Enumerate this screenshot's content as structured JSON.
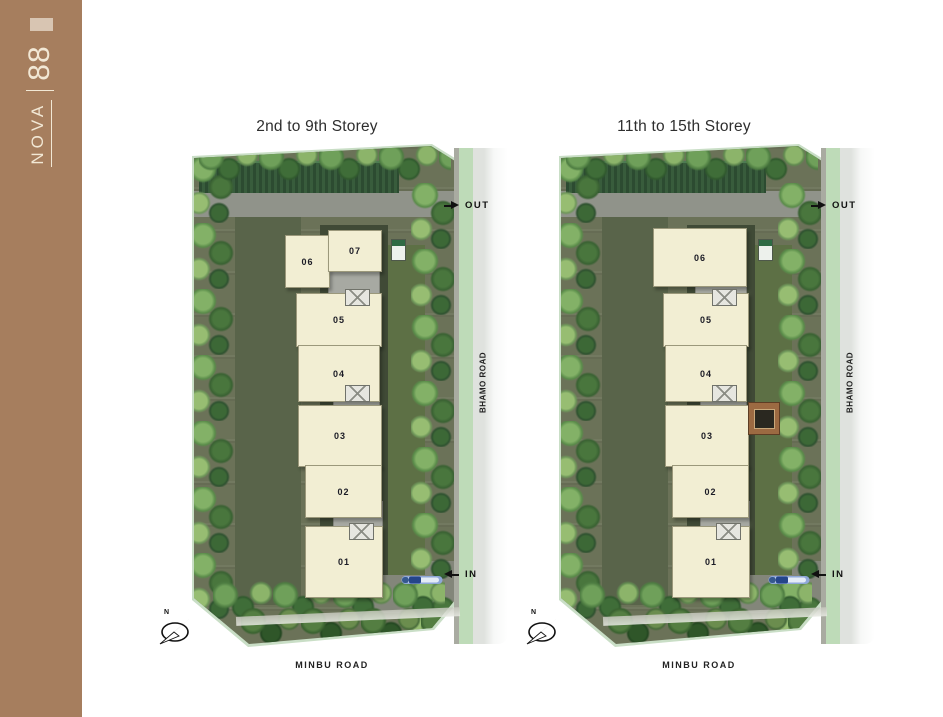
{
  "brand": {
    "name": "NOVA",
    "number": "88"
  },
  "colors": {
    "sidebar_brown": "#a67e5e",
    "logo_block": "#d8c5b2",
    "brand_text": "#f2e8d5",
    "unit_fill": "#f2eed3",
    "core_gray": "#a7a9a2",
    "road_green_strip": "#bedbb8",
    "ground_olive": "#6b7258"
  },
  "plans": [
    {
      "title": "2nd to 9th Storey",
      "out_label": "OUT",
      "in_label": "IN",
      "side_road_label": "BHAMO ROAD",
      "bottom_road_label": "MINBU ROAD",
      "compass_label": "N",
      "units": [
        {
          "label": "06",
          "x": 100,
          "y": 90,
          "w": 43,
          "h": 51
        },
        {
          "label": "07",
          "x": 143,
          "y": 85,
          "w": 52,
          "h": 40
        },
        {
          "label": "05",
          "x": 111,
          "y": 148,
          "w": 84,
          "h": 52
        },
        {
          "label": "04",
          "x": 113,
          "y": 200,
          "w": 80,
          "h": 55
        },
        {
          "label": "03",
          "x": 113,
          "y": 260,
          "w": 82,
          "h": 60
        },
        {
          "label": "02",
          "x": 120,
          "y": 320,
          "w": 75,
          "h": 51
        },
        {
          "label": "01",
          "x": 120,
          "y": 381,
          "w": 76,
          "h": 70
        }
      ],
      "cores": [
        {
          "x": 143,
          "y": 123,
          "w": 50,
          "h": 38
        },
        {
          "x": 148,
          "y": 238,
          "w": 45,
          "h": 40
        },
        {
          "x": 148,
          "y": 356,
          "w": 48,
          "h": 42
        }
      ],
      "lifts": [
        {
          "x": 160,
          "y": 144,
          "w": 23,
          "h": 15
        },
        {
          "x": 160,
          "y": 240,
          "w": 23,
          "h": 15
        },
        {
          "x": 164,
          "y": 378,
          "w": 23,
          "h": 15
        }
      ],
      "features": {
        "utility_box": true,
        "frame_marker": false
      }
    },
    {
      "title": "11th to 15th Storey",
      "out_label": "OUT",
      "in_label": "IN",
      "side_road_label": "BHAMO ROAD",
      "bottom_road_label": "MINBU ROAD",
      "compass_label": "N",
      "units": [
        {
          "label": "06",
          "x": 101,
          "y": 83,
          "w": 92,
          "h": 57
        },
        {
          "label": "05",
          "x": 111,
          "y": 148,
          "w": 84,
          "h": 52
        },
        {
          "label": "04",
          "x": 113,
          "y": 200,
          "w": 80,
          "h": 55
        },
        {
          "label": "03",
          "x": 113,
          "y": 260,
          "w": 82,
          "h": 60
        },
        {
          "label": "02",
          "x": 120,
          "y": 320,
          "w": 75,
          "h": 51
        },
        {
          "label": "01",
          "x": 120,
          "y": 381,
          "w": 76,
          "h": 70
        }
      ],
      "cores": [
        {
          "x": 143,
          "y": 123,
          "w": 50,
          "h": 38
        },
        {
          "x": 148,
          "y": 238,
          "w": 45,
          "h": 40
        },
        {
          "x": 148,
          "y": 356,
          "w": 48,
          "h": 42
        }
      ],
      "lifts": [
        {
          "x": 160,
          "y": 144,
          "w": 23,
          "h": 15
        },
        {
          "x": 160,
          "y": 240,
          "w": 23,
          "h": 15
        },
        {
          "x": 164,
          "y": 378,
          "w": 23,
          "h": 15
        }
      ],
      "features": {
        "utility_box": true,
        "frame_marker": true
      }
    }
  ]
}
